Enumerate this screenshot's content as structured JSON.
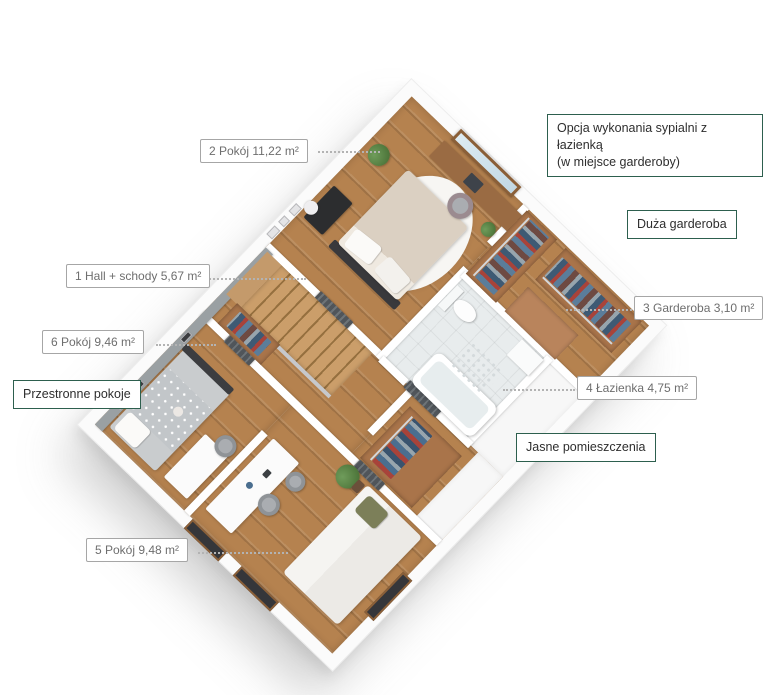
{
  "canvas": {
    "width": 768,
    "height": 695,
    "background": "#ffffff"
  },
  "palette": {
    "accent_green": "#2d5f4e",
    "label_gray_border": "#a6a6a6",
    "label_gray_text": "#6e6e6e",
    "label_dark_text": "#2e2e2e",
    "wood_floor": "#b5824f",
    "wardrobe_wood": "#a9744a",
    "tile_floor": "#e8eced",
    "accent_wall_gray": "#9aa0a3"
  },
  "area_labels": [
    {
      "id": "room-2",
      "text": "2 Pokój 11,22 m²"
    },
    {
      "id": "hall-schody-1",
      "text": "1 Hall + schody 5,67 m²"
    },
    {
      "id": "garderoba-3",
      "text": "3 Garderoba 3,10 m²"
    },
    {
      "id": "room-6",
      "text": "6 Pokój 9,46 m²"
    },
    {
      "id": "lazienka-4",
      "text": "4 Łazienka 4,75 m²"
    },
    {
      "id": "room-5",
      "text": "5 Pokój 9,48 m²"
    }
  ],
  "feature_labels": [
    {
      "id": "option-note",
      "line1": "Opcja wykonania sypialni z łazienką",
      "line2": "(w miejsce garderoby)"
    },
    {
      "id": "duza-garderoba",
      "text": "Duża garderoba"
    },
    {
      "id": "przestronne-pokoje",
      "text": "Przestronne pokoje"
    },
    {
      "id": "jasne-pomieszczenia",
      "text": "Jasne pomieszczenia"
    }
  ]
}
